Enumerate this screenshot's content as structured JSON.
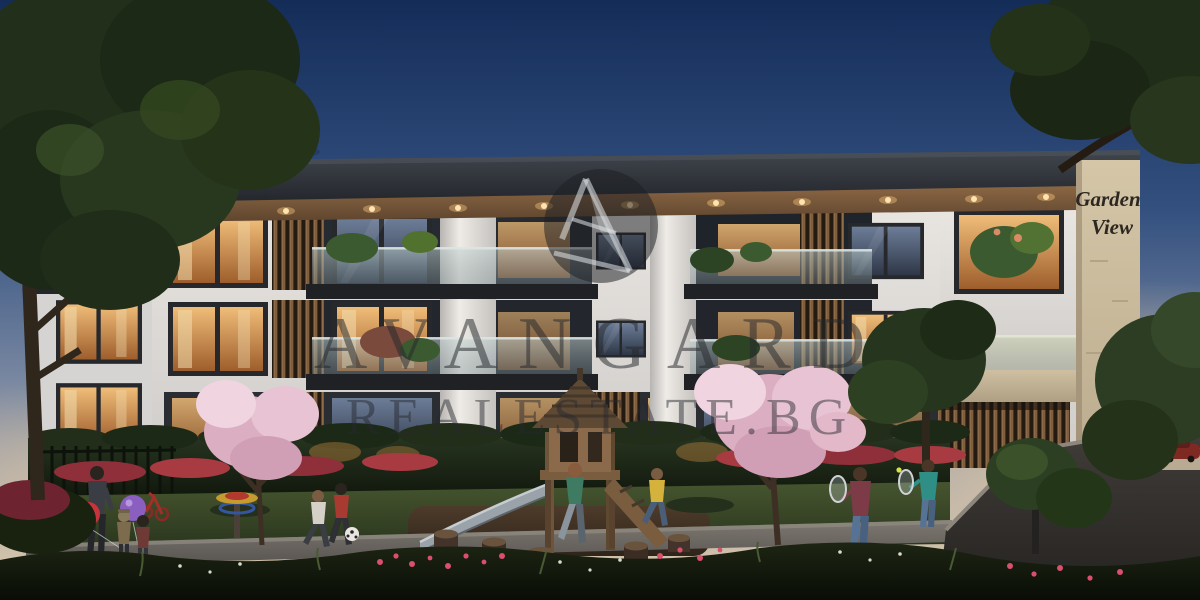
{
  "watermark": {
    "brand": "AVANGARD",
    "domain": "REALESTATE.BG",
    "logo_icon": "avangard-monogram-icon",
    "color": "rgba(38,40,45,0.5)"
  },
  "building_sign": {
    "line1": "Garden",
    "line2": "View"
  },
  "palette": {
    "sky_top": "#142c58",
    "sky_mid": "#51688f",
    "sky_horizon": "#e2cda9",
    "roof": "#2b2e34",
    "facade": "#e8e5e1",
    "window_frame": "#26282c",
    "window_warm": "#e0a45f",
    "window_cool": "#5d6c86",
    "wood_slats": "#7c5f43",
    "stone": "#c7b698",
    "glass_rail": "#9fb4b6",
    "hedge": "#1b2514",
    "lawn": "#3c4a29",
    "blossom_pink": "#e6bccd",
    "flower_red": "#b03840",
    "path": "#6f6a64",
    "road": "#35322f",
    "balloon_red": "#c5333b",
    "balloon_purple": "#8a5fc0",
    "soffit_light": "#ffd9a3"
  },
  "scene": {
    "caption": "Dusk rendering of a modern three-storey residence with gardens and playground",
    "elements": [
      "evening sky",
      "large trees",
      "flat-roof white building",
      "wood slat panels",
      "glass balconies",
      "stone pylon with Garden View sign",
      "slat garage doors",
      "hedge",
      "blossom trees",
      "wooden play tower with slide",
      "children playing football",
      "father and children with balloons",
      "girls playing badminton",
      "flower beds",
      "street and bollard light",
      "parked car"
    ]
  }
}
